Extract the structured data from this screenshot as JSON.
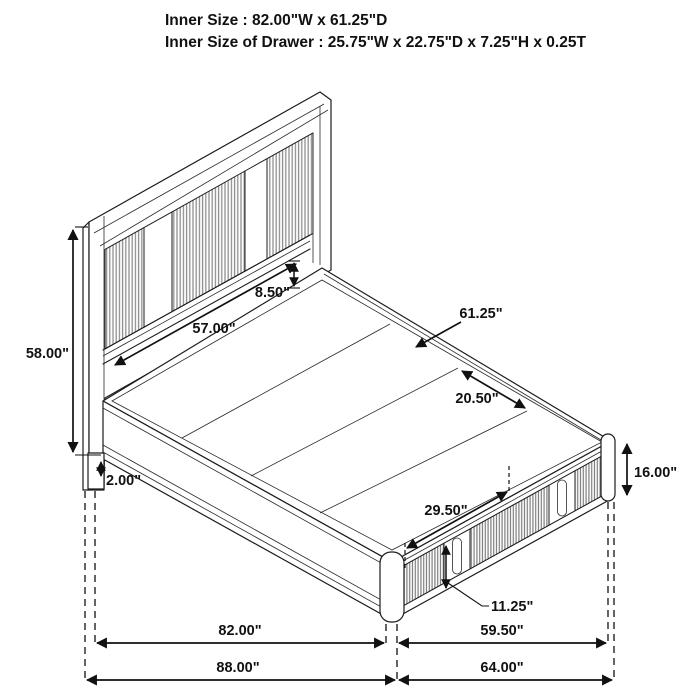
{
  "title": {
    "line1": "Inner Size : 82.00\"W x 61.25\"D",
    "line2": "Inner Size of Drawer : 25.75\"W x 22.75\"D x 7.25\"H x 0.25T"
  },
  "product": "storage platform bed with headboard and footboard drawers",
  "dimensions": {
    "headboard_height": "58.00\"",
    "headboard_inner_width": "57.00\"",
    "headboard_to_deck_gap": "8.50\"",
    "deck_inner_depth": "61.25\"",
    "deck_plank_width": "20.50\"",
    "drawer_width": "29.50\"",
    "side_rail_height": "16.00\"",
    "drawer_front_height": "11.25\"",
    "floor_clearance": "2.00\"",
    "inner_width": "82.00\"",
    "inner_depth_side": "59.50\"",
    "overall_width": "88.00\"",
    "overall_depth": "64.00\""
  },
  "colors": {
    "background": "#ffffff",
    "line": "#1c1c1c",
    "headboard_slat": "#8f8f8f",
    "drawer_slat": "#7d7d7d",
    "annotation": "#111111"
  }
}
